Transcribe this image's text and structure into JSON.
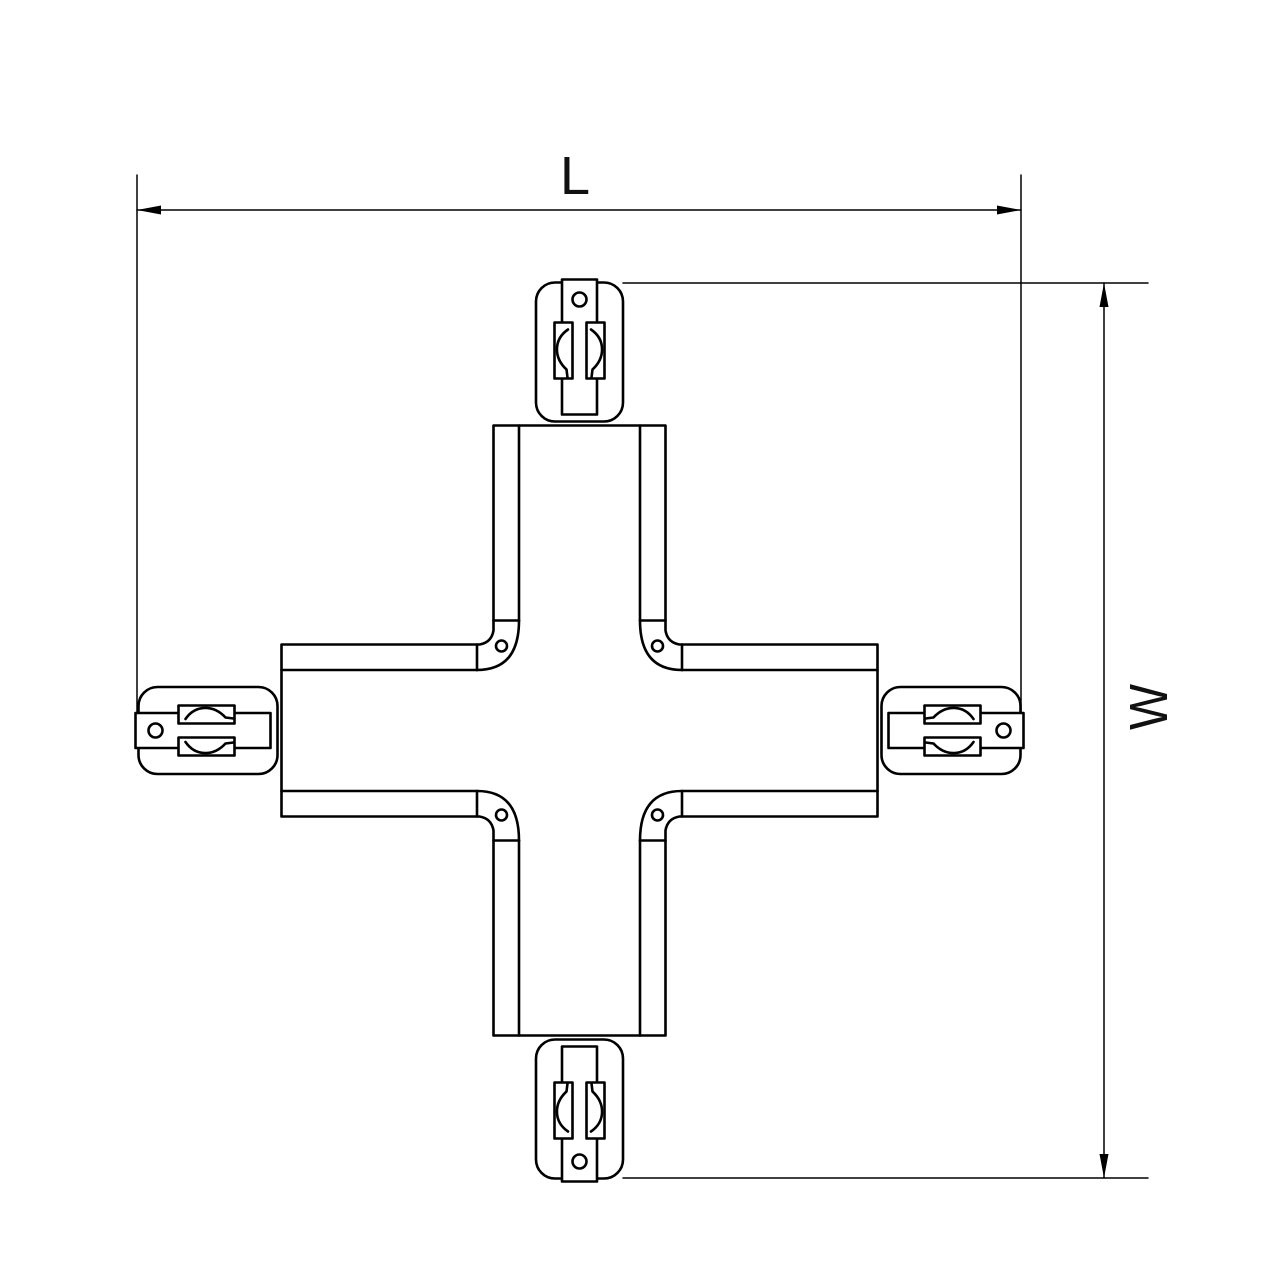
{
  "canvas": {
    "background": "#ffffff",
    "line_color": "#000000"
  },
  "diagram": {
    "name": "X-shaped four-way track connector, plan view technical drawing",
    "dimension_horizontal": {
      "label": "L"
    },
    "dimension_vertical": {
      "label": "W"
    },
    "features": {
      "end_caps": 4,
      "corner_screws": 4,
      "contact_windows_per_cap": 2,
      "hole_per_cap": 1
    }
  }
}
